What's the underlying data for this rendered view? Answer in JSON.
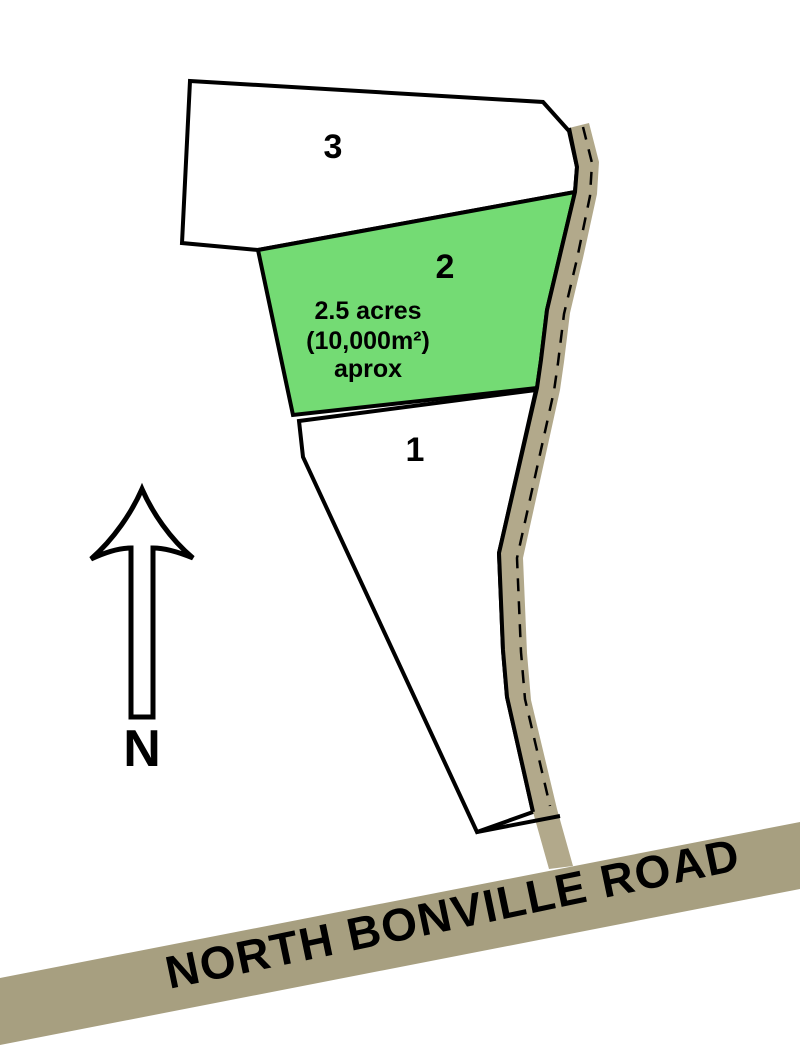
{
  "colors": {
    "background": "#FFFFFF",
    "outline": "#000000",
    "lot_fill": "#FFFFFF",
    "lot2_fill": "#74DB74",
    "access_road_fill": "#B2A98B",
    "main_road_fill": "#A79F80",
    "text": "#000000"
  },
  "lots": {
    "lot3": {
      "label": "3"
    },
    "lot2": {
      "label": "2",
      "area": "2.5 acres",
      "area_metric": "(10,000m²)",
      "area_qualifier": "aprox"
    },
    "lot1": {
      "label": "1"
    }
  },
  "compass": {
    "label": "N"
  },
  "main_road": {
    "name": "NORTH BONVILLE ROAD"
  }
}
